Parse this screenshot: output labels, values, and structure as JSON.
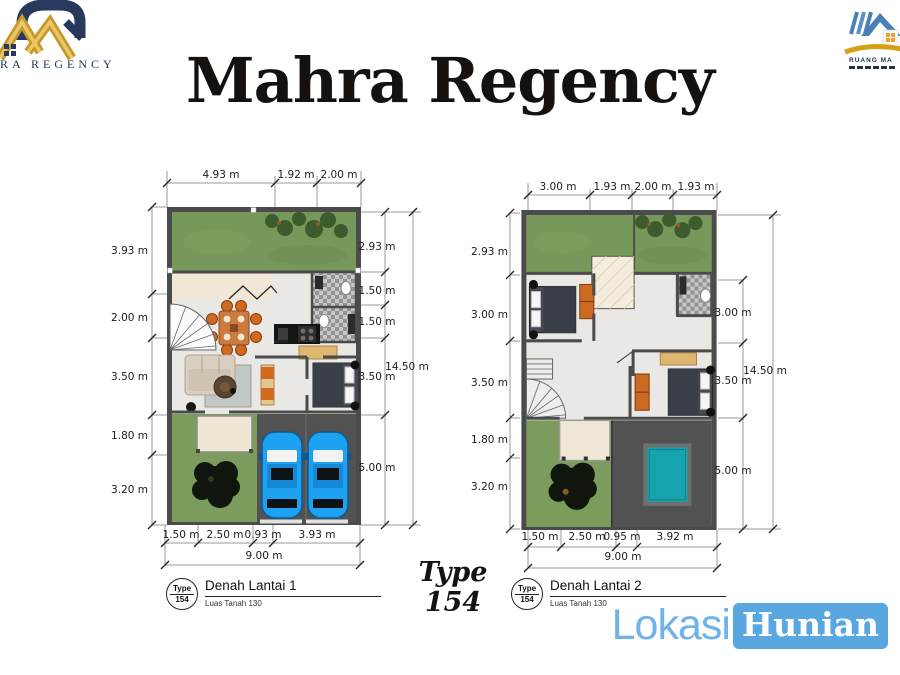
{
  "header": {
    "title": "Mahra Regency",
    "logo_left": {
      "text": "RA REGENCY"
    },
    "logo_right": {
      "text": "RUANG MA"
    }
  },
  "type_badge": {
    "line1": "Type",
    "line2": "154"
  },
  "watermark": {
    "part1": "Lokasi",
    "part2": "Hunian"
  },
  "plans": [
    {
      "title_block": {
        "type_label": "Type",
        "type_value": "154",
        "title": "Denah Lantai 1",
        "subtitle": "Luas Tanah 130"
      },
      "top_dims": [
        "4.93 m",
        "1.92 m",
        "2.00 m"
      ],
      "left_dims": [
        "3.93 m",
        "2.00 m",
        "3.50 m",
        "1.80 m",
        "3.20 m"
      ],
      "right_dims": [
        "2.93 m",
        "1.50 m",
        "1.50 m",
        "3.50 m",
        "5.00 m"
      ],
      "right_total": "14.50 m",
      "bottom_dims": [
        "1.50 m",
        "2.50 m",
        "0.93 m",
        "3.93 m"
      ],
      "bottom_total": "9.00 m"
    },
    {
      "title_block": {
        "type_label": "Type",
        "type_value": "154",
        "title": "Denah Lantai 2",
        "subtitle": "Luas Tanah 130"
      },
      "top_dims": [
        "3.00 m",
        "1.93 m",
        "2.00 m",
        "1.93 m"
      ],
      "left_dims": [
        "2.93 m",
        "3.00 m",
        "3.50 m",
        "1.80 m",
        "3.20 m"
      ],
      "right_dims": [
        "3.00 m",
        "3.50 m",
        "5.00 m"
      ],
      "right_total": "14.50 m",
      "bottom_dims": [
        "1.50 m",
        "2.50 m",
        "0.95 m",
        "3.92 m"
      ],
      "bottom_total": "9.00 m"
    }
  ],
  "colors": {
    "navy": "#27395c",
    "gold": "#c9982a",
    "grass": "#76985a",
    "wall": "#4b4b4b",
    "car_blue": "#1da2f2",
    "pool_teal": "#17a3ad",
    "lokasi_blue": "#6fb3e8",
    "accent_blue": "#58a7e0"
  }
}
